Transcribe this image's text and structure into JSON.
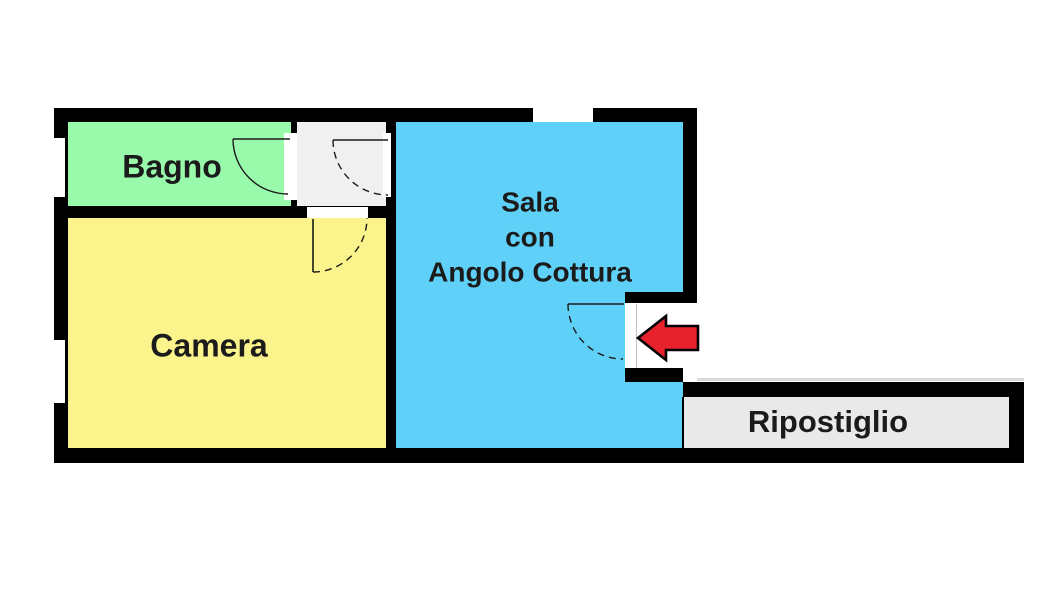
{
  "rooms": {
    "bagno": {
      "label": "Bagno",
      "color": "#9AFAAB"
    },
    "camera": {
      "label": "Camera",
      "color": "#FBF38B"
    },
    "sala": {
      "lines": [
        "Sala",
        "con",
        "Angolo Cottura"
      ],
      "color": "#5FD0F7"
    },
    "ripostiglio": {
      "label": "Ripostiglio",
      "color": "#E9E9E9"
    },
    "hallway": {
      "color": "#F0F0F0"
    }
  },
  "colors": {
    "wall": "#000000",
    "background": "#FFFFFF",
    "door_line": "#1A1A1A",
    "arrow_fill": "#E8222D",
    "arrow_outline": "#000000"
  },
  "entrance": {
    "icon": "arrow-left-icon"
  }
}
